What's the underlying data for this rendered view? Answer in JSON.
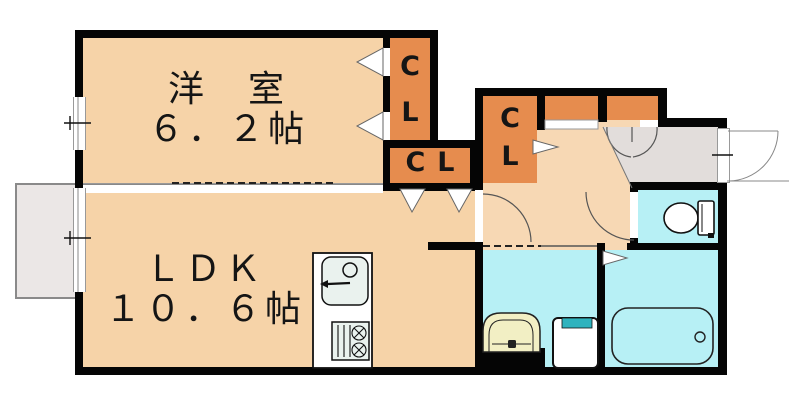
{
  "plan_title": "apartment-floor-plan",
  "rooms": {
    "western_room": {
      "name": "洋　室",
      "size": "６．２帖"
    },
    "ldk": {
      "name": "ＬＤＫ",
      "size": "１０．６帖"
    }
  },
  "closets": {
    "cl1": {
      "line1": "C",
      "line2": "L"
    },
    "cl2": {
      "text": "CL"
    },
    "cl3": {
      "line1": "C",
      "line2": "L"
    }
  },
  "fixtures": [
    "kitchen-sink",
    "stove",
    "washbasin",
    "washing-machine",
    "bathtub",
    "toilet",
    "entrance-door",
    "balcony-window"
  ],
  "colors": {
    "room_fill": "#F6D3A8",
    "hall_fill": "#F7D8B4",
    "closet_fill": "#E68C4E",
    "wet_area_fill": "#B7F0F5",
    "entry_fill": "#E2DDDB",
    "wall": "#050505",
    "fixture_cream": "#F2EFC4",
    "washer_accent": "#2FB3BE",
    "counter_fill": "#EAF2EE",
    "balcony_fill": "#EBE7E6"
  }
}
